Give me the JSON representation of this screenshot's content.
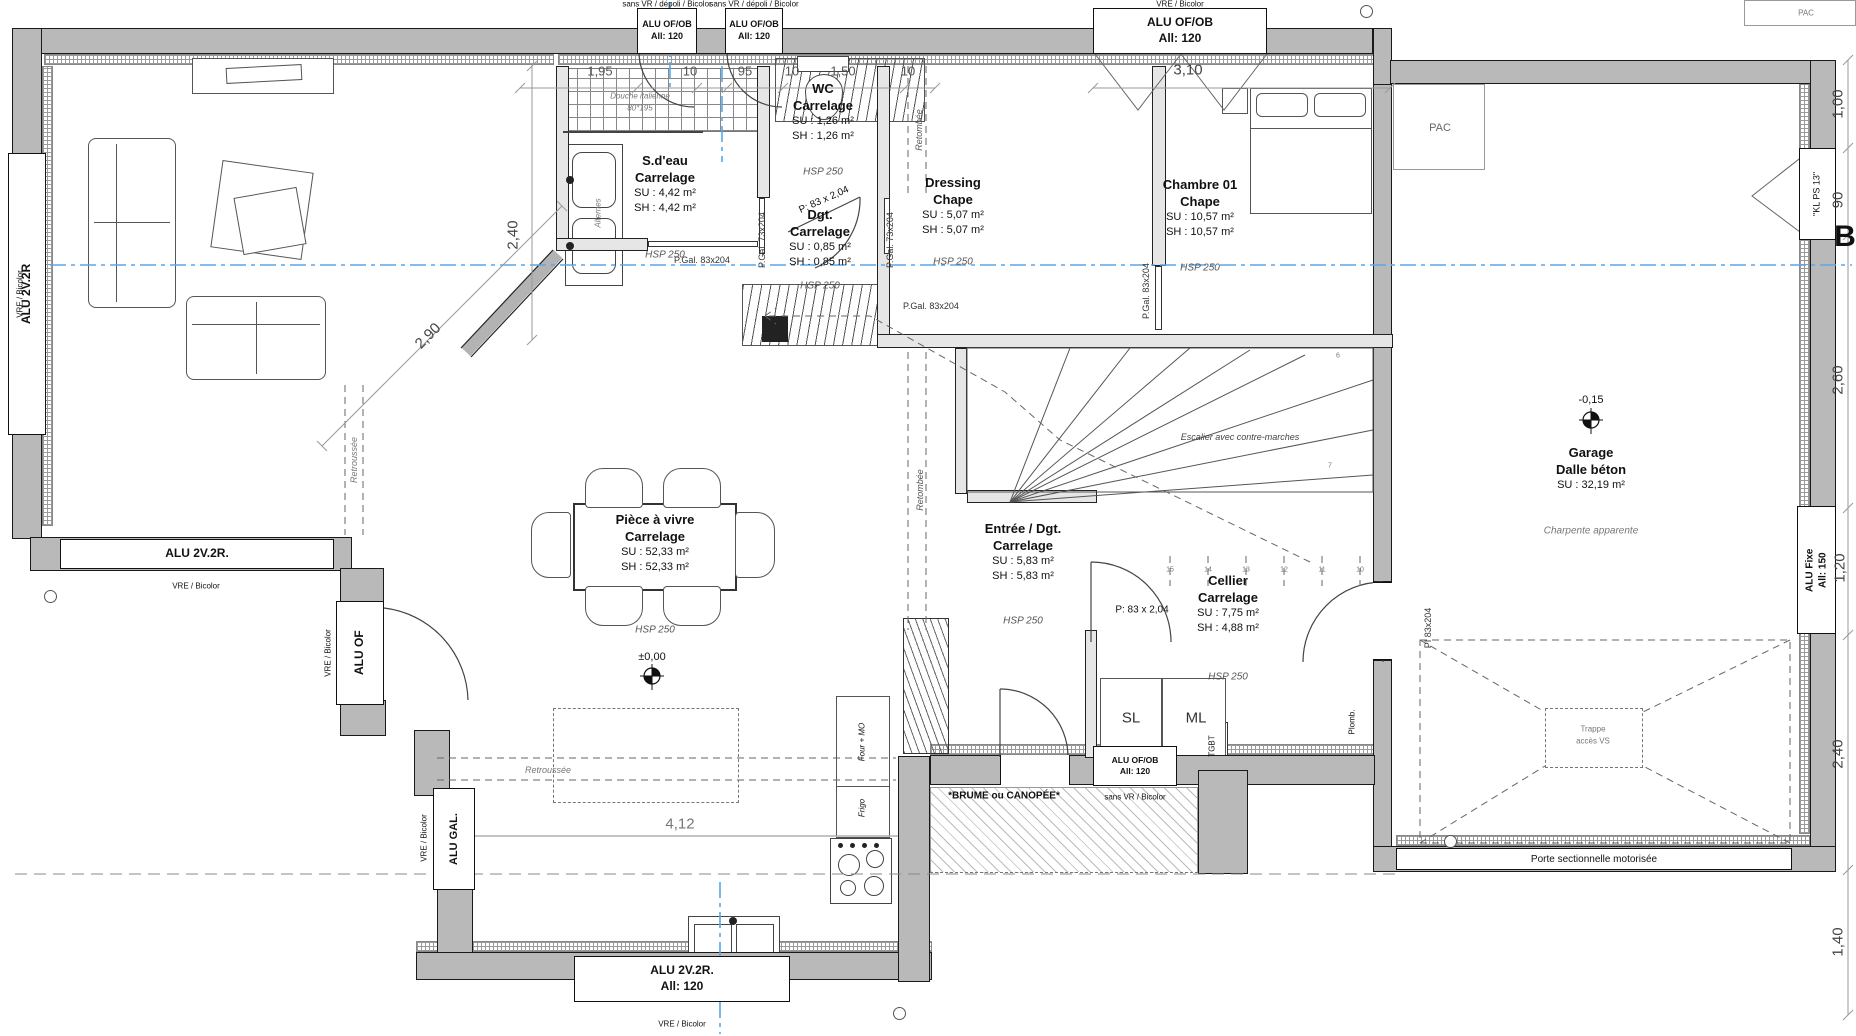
{
  "rooms": {
    "sdeau": {
      "name": "S.d'eau",
      "material": "Carrelage",
      "su": "SU : 4,42 m²",
      "sh": "SH : 4,42 m²",
      "hsp": "HSP 250"
    },
    "wc": {
      "name": "WC",
      "material": "Carrelage",
      "su": "SU : 1,26 m²",
      "sh": "SH : 1,26 m²",
      "hsp": "HSP 250"
    },
    "dgt": {
      "name": "Dgt.",
      "material": "Carrelage",
      "su": "SU : 0,85 m²",
      "sh": "SH : 0,85 m²",
      "hsp": "HSP 250"
    },
    "dressing": {
      "name": "Dressing",
      "material": "Chape",
      "su": "SU : 5,07 m²",
      "sh": "SH : 5,07 m²",
      "hsp": "HSP 250"
    },
    "chambre": {
      "name": "Chambre 01",
      "material": "Chape",
      "su": "SU : 10,57 m²",
      "sh": "SH : 10,57 m²",
      "hsp": "HSP 250"
    },
    "piece": {
      "name": "Pièce à vivre",
      "material": "Carrelage",
      "su": "SU : 52,33 m²",
      "sh": "SH : 52,33 m²",
      "hsp": "HSP 250"
    },
    "entree": {
      "name": "Entrée / Dgt.",
      "material": "Carrelage",
      "su": "SU : 5,83 m²",
      "sh": "SH : 5,83 m²",
      "hsp": "HSP 250"
    },
    "cellier": {
      "name": "Cellier",
      "material": "Carrelage",
      "su": "SU : 7,75 m²",
      "sh": "SH : 4,88 m²",
      "hsp": "HSP 250"
    },
    "garage": {
      "name": "Garage",
      "material": "Dalle béton",
      "su": "SU : 32,19 m²",
      "note": "Charpente apparente"
    }
  },
  "windows": {
    "top1": {
      "label": "ALU OF/OB",
      "allege": "All: 120",
      "note": "sans VR / dépoli / Bicolor"
    },
    "top2": {
      "label": "ALU OF/OB",
      "allege": "All: 120",
      "note": "sans VR / dépoli / Bicolor"
    },
    "top3": {
      "label": "ALU OF/OB",
      "allege": "All: 120",
      "note": "VRE / Bicolor"
    },
    "left_tall": {
      "label": "ALU 2V.2R",
      "note": "VRE / Bicolor"
    },
    "southwest": {
      "label": "ALU 2V.2R.",
      "note": "VRE / Bicolor"
    },
    "of_door": {
      "label": "ALU OF",
      "note": "VRE / Bicolor"
    },
    "gal": {
      "label": "ALU GAL.",
      "note": "VRE / Bicolor"
    },
    "kitchen_south": {
      "label": "ALU 2V.2R.",
      "allege": "All: 120",
      "note": "VRE / Bicolor"
    },
    "cellier_south": {
      "label": "ALU OF/OB",
      "allege": "All: 120",
      "note": "sans VR / Bicolor"
    },
    "garage_fixe": {
      "label": "ALU Fixe",
      "allege": "All: 150"
    },
    "garage_kl": {
      "label": "\"KL PS 13\""
    },
    "garage_door": {
      "label": "Porte sectionnelle motorisée"
    }
  },
  "doors": {
    "pgal73_a": "P.Gal. 73x204",
    "pgal73_b": "P.Gal. 73x204",
    "pgal83_sdb": "P.Gal. 83x204",
    "pgal83_dressing": "P.Gal. 83x204",
    "pgal83_chambre": "P.Gal. 83x204",
    "pi83": "PI 83x204",
    "p83_wc": "P: 83 x 2,04",
    "p83_cellier": "P: 83 x 2,04"
  },
  "dimensions": {
    "top": [
      "1,95",
      "10",
      "95",
      "10",
      "1,50",
      "10"
    ],
    "chambre_width": "3,10",
    "sdeau_height": "2,40",
    "living_diag": "2,90",
    "kitchen_width": "4,12",
    "right": [
      "1,00",
      "90",
      "2,60",
      "1,20",
      "2,40",
      "1,40"
    ]
  },
  "levels": {
    "ground": "±0,00",
    "garage": "-0,15"
  },
  "annotations": {
    "shower_line1": "Douche italienne",
    "shower_line2": "80*195",
    "alternes": "Alternes",
    "retombee_top": "Retombée",
    "retombee_entree": "Retombée",
    "retroussee_living": "Retroussée",
    "retroussee_kitchen": "Retroussée",
    "stairs": "Escalier avec contre-marches",
    "terrace": "*BRUME ou CANOPÉE*",
    "trappe_line1": "Trappe",
    "trappe_line2": "accès VS",
    "section_marker": "B"
  },
  "equipment": {
    "pac": "PAC",
    "pac_corner": "PAC",
    "tgbt": "TGBT",
    "plomb": "Plomb.",
    "sl": "SL",
    "ml": "ML",
    "four": "Four + MO",
    "frigo": "Frigo"
  },
  "stairs": {
    "treads": [
      "15",
      "14",
      "13",
      "12",
      "11",
      "10"
    ],
    "winder_treads": [
      "6",
      "7"
    ]
  },
  "colors": {
    "wall": "#b9b9b9",
    "accent_blue": "#5aa7e8",
    "dim_gray": "#8a8a8a"
  }
}
